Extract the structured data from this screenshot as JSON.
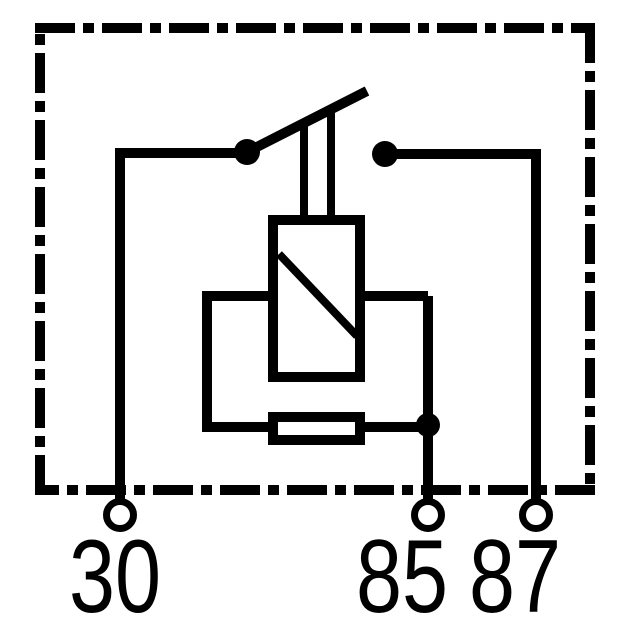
{
  "diagram": {
    "colors": {
      "line": "#000000",
      "background": "#ffffff"
    },
    "components": {
      "housing": "relay-housing-dash-dot-outline",
      "switch": "switch-contact-blade",
      "coil": "relay-coil-with-diagonal",
      "resistor": "parallel-resistor"
    },
    "terminals": [
      {
        "id": "terminal-30",
        "label": "30"
      },
      {
        "id": "terminal-85",
        "label": "85"
      },
      {
        "id": "terminal-87",
        "label": "87"
      }
    ]
  }
}
